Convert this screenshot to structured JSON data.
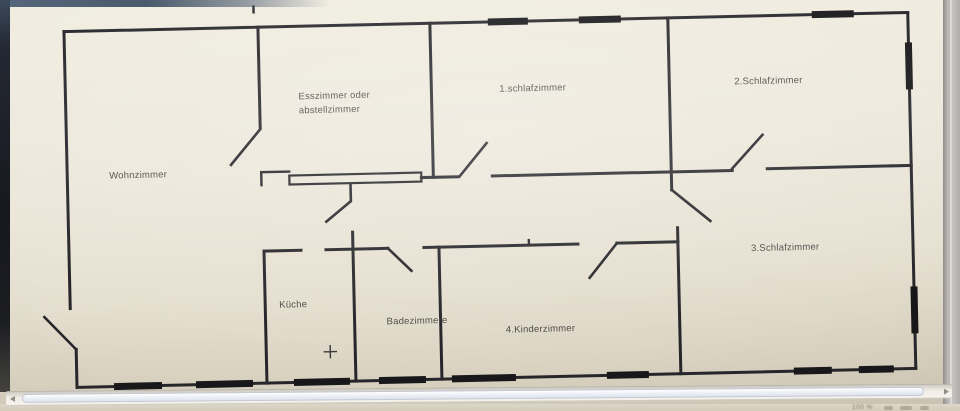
{
  "chrome": {
    "scrollbar": {
      "orientation": "horizontal",
      "thumb": "nearly-full-width"
    },
    "status_zoom_text": "100 %"
  },
  "floorplan": {
    "rooms": [
      {
        "id": "wohnzimmer",
        "label": "Wohnzimmer"
      },
      {
        "id": "esszimmer-oder-abstellzimmer",
        "label_line1": "Esszimmer oder",
        "label_line2": "abstellzimmer"
      },
      {
        "id": "schlafzimmer-1",
        "label": "1.schlafzimmer"
      },
      {
        "id": "schlafzimmer-2",
        "label": "2.Schlafzimmer"
      },
      {
        "id": "schlafzimmer-3",
        "label": "3.Schlafzimmer"
      },
      {
        "id": "kueche",
        "label": "Küche"
      },
      {
        "id": "badezimmer",
        "label": "Badezimmere"
      },
      {
        "id": "kinderzimmer",
        "label": "4.Kinderzimmer"
      }
    ],
    "colors": {
      "paper_beige": "#ebe6d9",
      "wall_black": "#26262a",
      "label_gray": "#44433f",
      "bezel_dark": "#17181f",
      "top_strip_blue": "#4a5a6c",
      "side_chrome_gray": "#b6b4b1",
      "scrollbar_thumb": "#e3e9f2"
    }
  }
}
